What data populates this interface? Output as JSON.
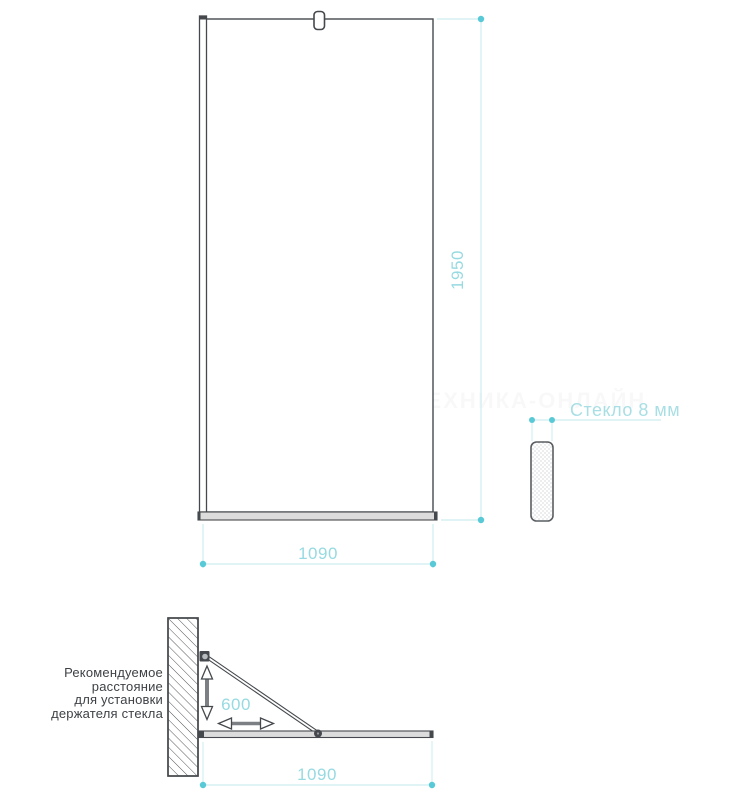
{
  "drawing": {
    "front_view": {
      "height_dim": "1950",
      "width_dim": "1090",
      "glass_thickness_label": "Стекло 8 мм"
    },
    "top_view": {
      "holder_distance_dim": "600",
      "width_dim": "1090",
      "note_lines": [
        "Рекомендуемое",
        "расстояние",
        "для установки",
        "держателя стекла"
      ]
    },
    "watermark": "САНТЕХНИКА-ОНЛАЙН"
  },
  "colors": {
    "outline_dark": "#45494d",
    "dimension_dot": "#58c9d6",
    "dimension_line": "#cdeef1",
    "dimension_text": "#97dae1",
    "note_text": "#3e4246",
    "profile_fill": "#dcdcdc"
  }
}
